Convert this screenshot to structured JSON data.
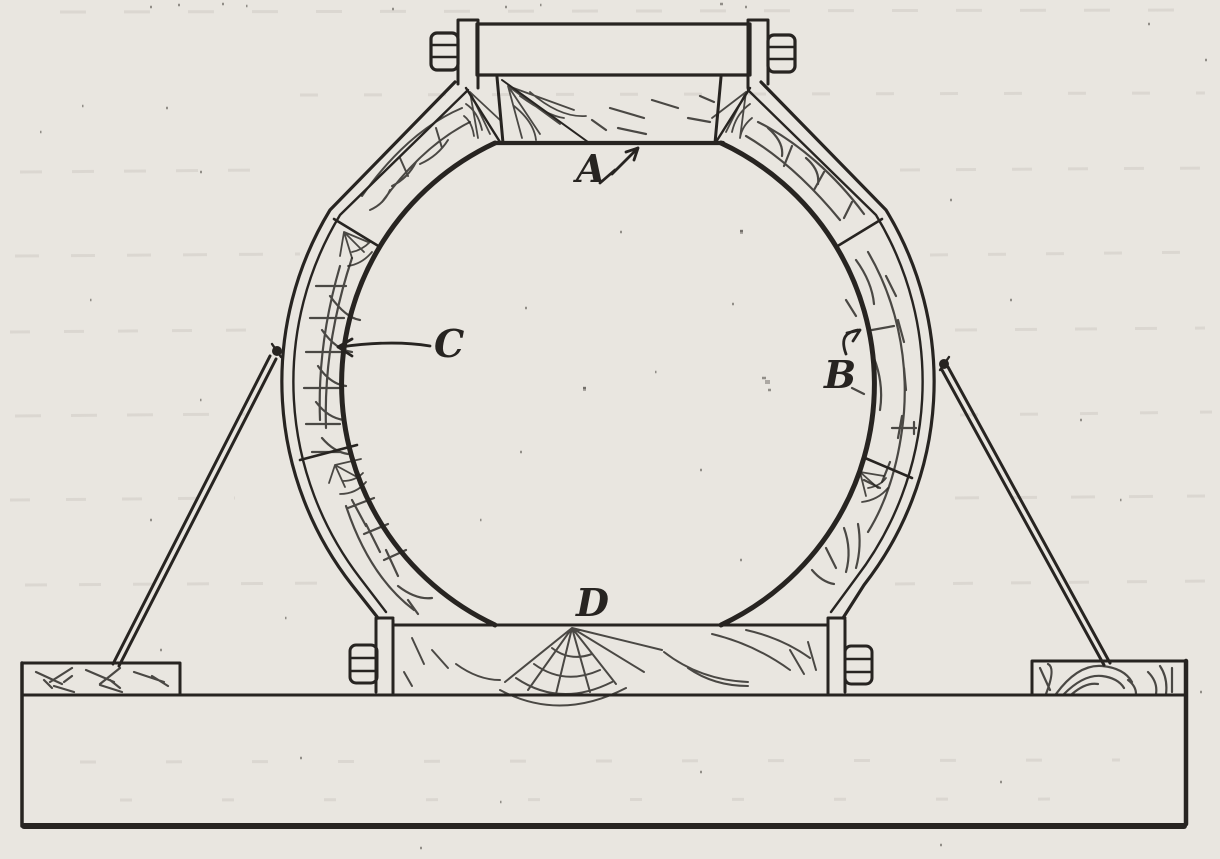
{
  "figure": {
    "labels": {
      "a": "A",
      "b": "B",
      "c": "C",
      "d": "D"
    }
  },
  "colors": {
    "paper": "#e9e6e0",
    "ink": "#272421",
    "faint_ink": "#7a756b"
  }
}
